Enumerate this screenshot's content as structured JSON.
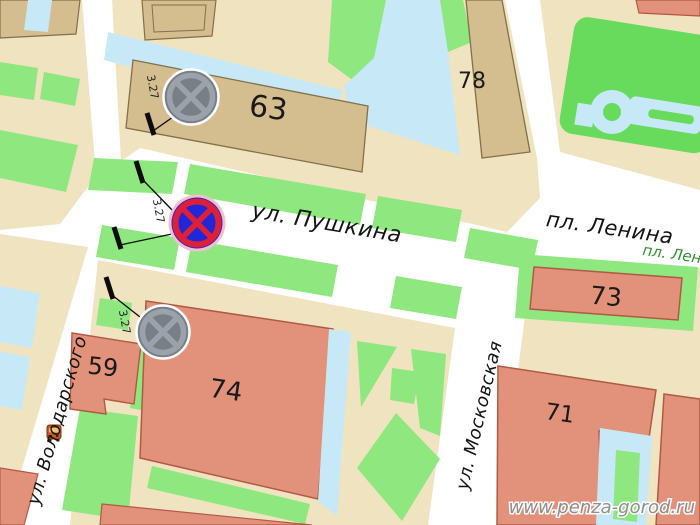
{
  "map": {
    "title": "Penza city map fragment — Pushkina / Lenin square area",
    "streets": {
      "pushkina": "ул. Пушкина",
      "lenina_square": "пл. Ленина",
      "lenina_square_small": "пл. Лен",
      "volodarskogo": "ул. Володарского",
      "moskovskaya": "ул. Московская"
    },
    "buildings": {
      "b63": "63",
      "b78": "78",
      "b73": "73",
      "b74": "74",
      "b71": "71",
      "b59": "59"
    },
    "signs": {
      "type": "no-stopping road sign 3.27",
      "labels": [
        "3.27",
        "3.27",
        "3.27"
      ],
      "active_color": "#2127d6",
      "active_ring": "#df1f38",
      "inactive_color": "#787f86"
    },
    "colors": {
      "road": "#ffffff",
      "block_beige": "#f0e3c0",
      "building_tan": "#d4bd8f",
      "building_tan_outline": "#82704a",
      "building_salmon": "#e2917b",
      "building_salmon_outline": "#b05a44",
      "lawn_green": "#8fe780",
      "park_green": "#68da5c",
      "path_blue": "#c7e9f7"
    },
    "watermark": "www.penza-gorod.ru"
  }
}
